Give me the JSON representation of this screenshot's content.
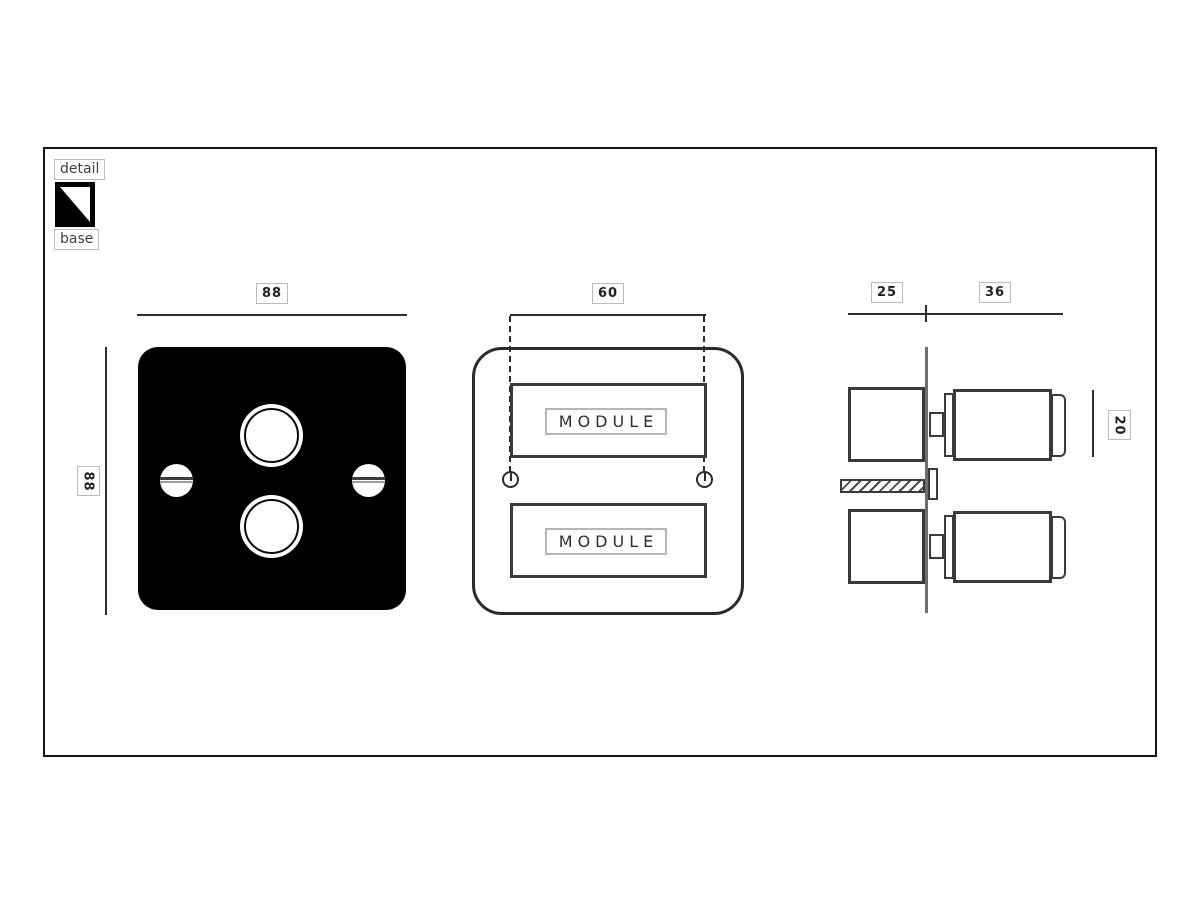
{
  "legend": {
    "detail_label": "detail",
    "base_label": "base"
  },
  "front_view": {
    "width_dim": "88",
    "height_dim": "88"
  },
  "module_view": {
    "width_dim": "60",
    "top_module_label": "MODULE",
    "bottom_module_label": "MODULE"
  },
  "side_view": {
    "back_depth_dim": "25",
    "front_depth_dim": "36",
    "knob_height_dim": "20"
  },
  "colors": {
    "line_dark": "#2e2e31",
    "label_border": "#bcbcbc",
    "plate_black": "#000000",
    "wall_gray": "#6e6e6e",
    "text_gray": "#404040"
  }
}
